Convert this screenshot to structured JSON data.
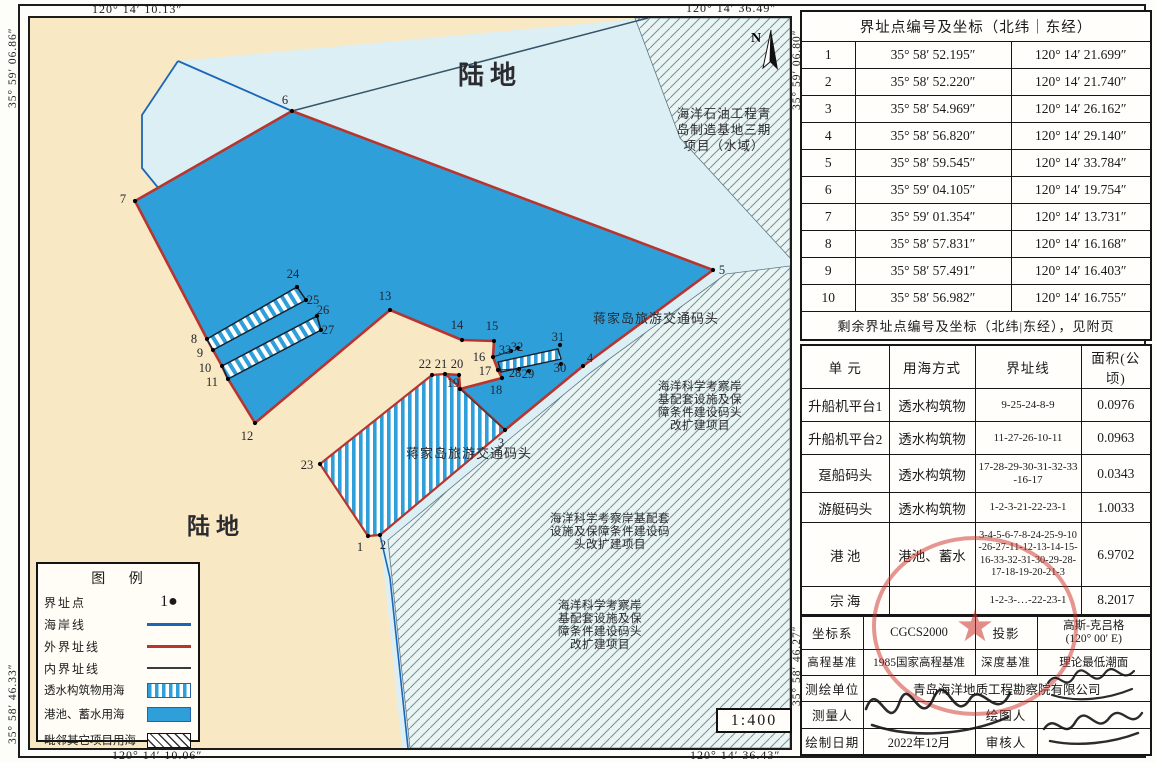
{
  "frame": {
    "coords": {
      "top_left": "120° 14′ 10.13″",
      "top_right": "120° 14′ 36.49″",
      "bottom_left": "120° 14′ 10.06″",
      "bottom_right": "120° 14′ 36.43″",
      "left_top": "35° 59′ 06.86″",
      "left_bottom": "35° 58′ 46.33″",
      "right_top": "35° 59′ 06.80″",
      "right_bottom": "35° 58′ 46.27″"
    },
    "scale": "1:400",
    "north": "N"
  },
  "map": {
    "labels": {
      "land_top": "陆地",
      "land_bottom": "陆地",
      "oil_project": [
        "海洋石油工程青",
        "岛制造基地三期",
        "项目（水域）"
      ],
      "jiajia_1": "蒋家岛旅游交通码头",
      "jiajia_2": "蒋家岛旅游交通码头",
      "science_right": [
        "海洋科学考察岸",
        "基配套设施及保",
        "障条件建设码头",
        "改扩建项目"
      ],
      "science_mid": [
        "海洋科学考察岸基配套",
        "设施及保障条件建设码",
        "头改扩建项目"
      ],
      "science_bottom": [
        "海洋科学考察岸",
        "基配套设施及保",
        "障条件建设码头",
        "改扩建项目"
      ]
    },
    "points": [
      {
        "n": "1",
        "x": 338,
        "y": 518,
        "lx": 330,
        "ly": 533
      },
      {
        "n": "2",
        "x": 350,
        "y": 517,
        "lx": 353,
        "ly": 531
      },
      {
        "n": "3",
        "x": 475,
        "y": 412,
        "lx": 471,
        "ly": 429
      },
      {
        "n": "4",
        "x": 553,
        "y": 348,
        "lx": 560,
        "ly": 344
      },
      {
        "n": "5",
        "x": 683,
        "y": 252,
        "lx": 692,
        "ly": 256
      },
      {
        "n": "6",
        "x": 262,
        "y": 93,
        "lx": 255,
        "ly": 86
      },
      {
        "n": "7",
        "x": 105,
        "y": 183,
        "lx": 93,
        "ly": 185
      },
      {
        "n": "8",
        "x": 177,
        "y": 321,
        "lx": 164,
        "ly": 325
      },
      {
        "n": "9",
        "x": 183,
        "y": 332,
        "lx": 170,
        "ly": 339
      },
      {
        "n": "10",
        "x": 192,
        "y": 348,
        "lx": 175,
        "ly": 354
      },
      {
        "n": "11",
        "x": 198,
        "y": 361,
        "lx": 182,
        "ly": 368
      },
      {
        "n": "12",
        "x": 225,
        "y": 405,
        "lx": 217,
        "ly": 422
      },
      {
        "n": "13",
        "x": 360,
        "y": 292,
        "lx": 355,
        "ly": 282
      },
      {
        "n": "14",
        "x": 432,
        "y": 322,
        "lx": 427,
        "ly": 311
      },
      {
        "n": "15",
        "x": 464,
        "y": 323,
        "lx": 462,
        "ly": 312
      },
      {
        "n": "16",
        "x": 463,
        "y": 339,
        "lx": 449,
        "ly": 343
      },
      {
        "n": "17",
        "x": 468,
        "y": 352,
        "lx": 455,
        "ly": 357
      },
      {
        "n": "18",
        "x": 472,
        "y": 360,
        "lx": 466,
        "ly": 376
      },
      {
        "n": "19",
        "x": 430,
        "y": 371,
        "lx": 423,
        "ly": 369
      },
      {
        "n": "20",
        "x": 429,
        "y": 357,
        "lx": 427,
        "ly": 350
      },
      {
        "n": "21",
        "x": 415,
        "y": 356,
        "lx": 411,
        "ly": 350
      },
      {
        "n": "22",
        "x": 402,
        "y": 357,
        "lx": 395,
        "ly": 350
      },
      {
        "n": "23",
        "x": 290,
        "y": 446,
        "lx": 277,
        "ly": 451
      },
      {
        "n": "24",
        "x": 267,
        "y": 269,
        "lx": 263,
        "ly": 260
      },
      {
        "n": "25",
        "x": 276,
        "y": 282,
        "lx": 283,
        "ly": 286
      },
      {
        "n": "26",
        "x": 287,
        "y": 298,
        "lx": 293,
        "ly": 296
      },
      {
        "n": "27",
        "x": 291,
        "y": 312,
        "lx": 298,
        "ly": 316
      },
      {
        "n": "28",
        "x": 489,
        "y": 351,
        "lx": 485,
        "ly": 359
      },
      {
        "n": "29",
        "x": 499,
        "y": 353,
        "lx": 498,
        "ly": 360
      },
      {
        "n": "30",
        "x": 531,
        "y": 346,
        "lx": 530,
        "ly": 354
      },
      {
        "n": "31",
        "x": 530,
        "y": 327,
        "lx": 528,
        "ly": 323
      },
      {
        "n": "32",
        "x": 488,
        "y": 330,
        "lx": 487,
        "ly": 333
      },
      {
        "n": "33",
        "x": 481,
        "y": 333,
        "lx": 475,
        "ly": 336
      }
    ]
  },
  "legend": {
    "title": "图  例",
    "items": [
      {
        "label": "界址点",
        "symbol": "point",
        "symbol_text": "1●"
      },
      {
        "label": "海岸线",
        "symbol": "line-blue"
      },
      {
        "label": "外界址线",
        "symbol": "line-red"
      },
      {
        "label": "内界址线",
        "symbol": "line-black"
      },
      {
        "label": "透水构筑物用海",
        "symbol": "vstripe"
      },
      {
        "label": "港池、蓄水用海",
        "symbol": "solid"
      },
      {
        "label": "毗邻其它项目用海",
        "symbol": "hatch"
      }
    ]
  },
  "coord_table": {
    "title": "界址点编号及坐标（北纬｜东经）",
    "rows": [
      {
        "id": "1",
        "lat": "35° 58′ 52.195″",
        "lon": "120° 14′ 21.699″"
      },
      {
        "id": "2",
        "lat": "35° 58′ 52.220″",
        "lon": "120° 14′ 21.740″"
      },
      {
        "id": "3",
        "lat": "35° 58′ 54.969″",
        "lon": "120° 14′ 26.162″"
      },
      {
        "id": "4",
        "lat": "35° 58′ 56.820″",
        "lon": "120° 14′ 29.140″"
      },
      {
        "id": "5",
        "lat": "35° 58′ 59.545″",
        "lon": "120° 14′ 33.784″"
      },
      {
        "id": "6",
        "lat": "35° 59′ 04.105″",
        "lon": "120° 14′ 19.754″"
      },
      {
        "id": "7",
        "lat": "35° 59′ 01.354″",
        "lon": "120° 14′ 13.731″"
      },
      {
        "id": "8",
        "lat": "35° 58′ 57.831″",
        "lon": "120° 14′ 16.168″"
      },
      {
        "id": "9",
        "lat": "35° 58′ 57.491″",
        "lon": "120° 14′ 16.403″"
      },
      {
        "id": "10",
        "lat": "35° 58′ 56.982″",
        "lon": "120° 14′ 16.755″"
      }
    ],
    "footer": "剩余界址点编号及坐标（北纬|东经），见附页"
  },
  "unit_table": {
    "headers": [
      "单  元",
      "用海方式",
      "界址线",
      "面积(公顷)"
    ],
    "rows": [
      [
        "升船机平台1",
        "透水构筑物",
        "9-25-24-8-9",
        "0.0976"
      ],
      [
        "升船机平台2",
        "透水构筑物",
        "11-27-26-10-11",
        "0.0963"
      ],
      [
        "趸船码头",
        "透水构筑物",
        "17-28-29-30-31-32-33-16-17",
        "0.0343"
      ],
      [
        "游艇码头",
        "透水构筑物",
        "1-2-3-21-22-23-1",
        "1.0033"
      ],
      [
        "港  池",
        "港池、蓄水",
        "3-4-5-6-7-8-24-25-9-10-26-27-11-12-13-14-15-16-33-32-31-30-29-28-17-18-19-20-21-3",
        "6.9702"
      ],
      [
        "宗  海",
        "",
        "1-2-3-…-22-23-1",
        "8.2017"
      ]
    ]
  },
  "info_table": {
    "r1": {
      "l1": "坐标系",
      "v1": "CGCS2000",
      "l2": "投影",
      "v2a": "高斯-克吕格",
      "v2b": "(120° 00′ E)"
    },
    "r2": {
      "l1": "高程基准",
      "v1": "1985国家高程基准",
      "l2": "深度基准",
      "v2": "理论最低潮面"
    },
    "r3": {
      "l1": "测绘单位",
      "v1": "青岛海洋地质工程勘察院有限公司"
    },
    "r4": {
      "l1": "测量人",
      "l2": "绘图人"
    },
    "r5": {
      "l1": "绘制日期",
      "v1": "2022年12月",
      "l2": "审核人"
    }
  },
  "colors": {
    "land": "#F8E8C4",
    "shallow_water": "#DCEFF4",
    "harbor_blue": "#2E9FD9",
    "outer_boundary_red": "#B8352F",
    "coastline_blue": "#1C66B8",
    "inner_boundary_black": "#3a3a42",
    "adjacent_hatch_bg": "#E9F4F3",
    "seal_red": "#CE2E28"
  }
}
